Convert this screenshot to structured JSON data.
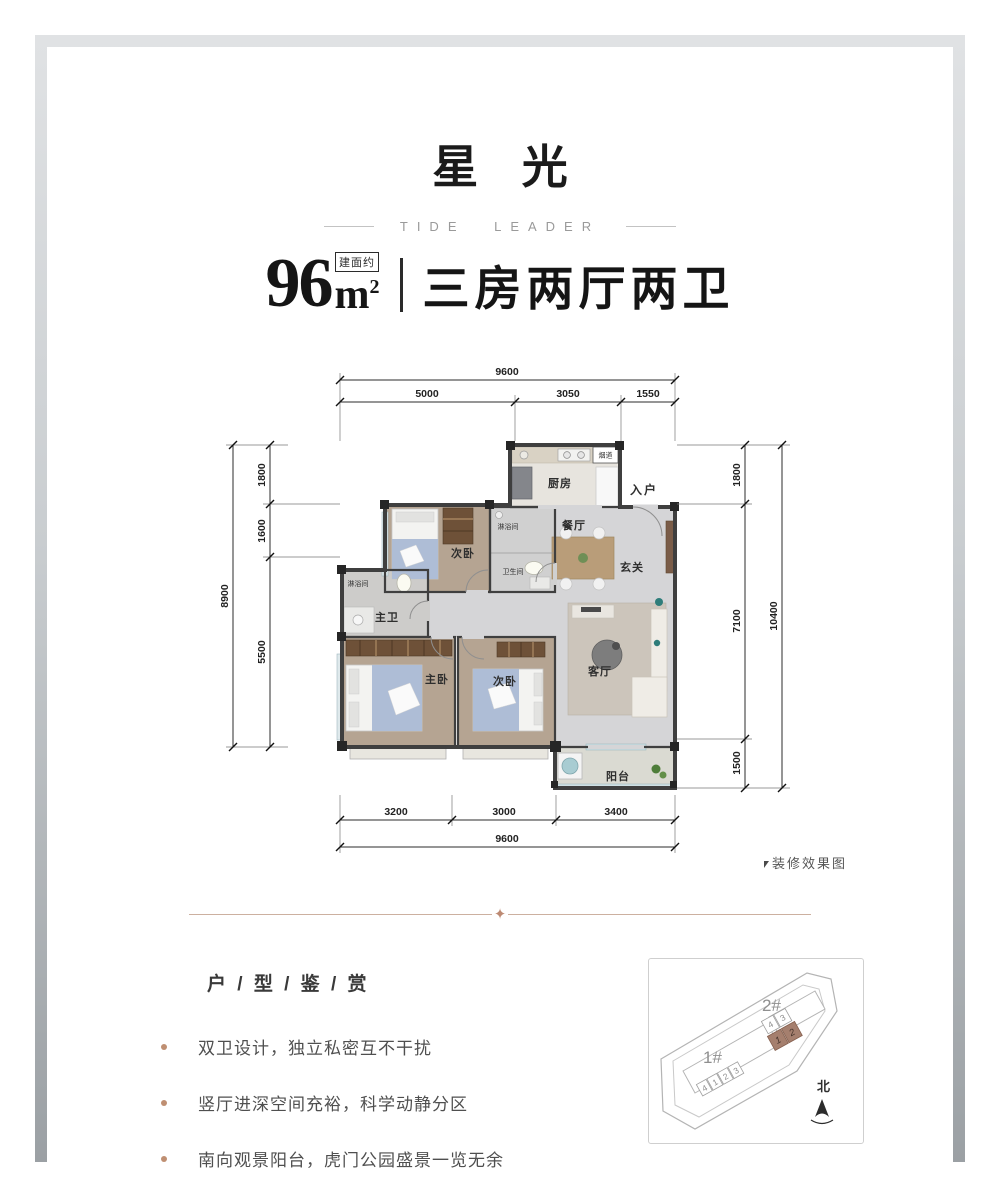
{
  "header": {
    "title": "星 光",
    "subtitle": "TIDE LEADER",
    "area": {
      "value": "96",
      "unit": "m",
      "sup": "2",
      "badge": "建面约"
    },
    "layout_text": "三房两厅两卫"
  },
  "floor_plan": {
    "note": "装修效果图",
    "labels": {
      "kitchen": "厨房",
      "flue": "烟道",
      "entry": "入户",
      "dining": "餐厅",
      "foyer": "玄关",
      "bedroom_top": "次卧",
      "shower_top": "淋浴间",
      "bathroom": "卫生间",
      "shower_left": "淋浴间",
      "master_bath": "主卫",
      "master_bedroom": "主卧",
      "bedroom_bottom": "次卧",
      "living": "客厅",
      "balcony": "阳台"
    },
    "dimensions": {
      "top": {
        "overall": "9600",
        "segments": [
          "5000",
          "3050",
          "1550"
        ]
      },
      "left": {
        "overall": "8900",
        "segments": [
          "1800",
          "1600",
          "5500"
        ]
      },
      "right": {
        "overall": "10400",
        "segments": [
          "1800",
          "7100",
          "1500"
        ]
      },
      "bottom": {
        "overall": "9600",
        "segments": [
          "3200",
          "3000",
          "3400"
        ]
      }
    }
  },
  "features": {
    "title": "户 / 型 / 鉴 / 赏",
    "bullets": [
      "双卫设计，独立私密互不干扰",
      "竖厅进深空间充裕，科学动静分区",
      "南向观景阳台，虎门公园盛景一览无余"
    ]
  },
  "sitemap": {
    "building1": "1#",
    "building2": "2#",
    "north": "北",
    "b1_units": [
      "4",
      "1",
      "2",
      "3"
    ],
    "b2_units_white": [
      "4",
      "3"
    ],
    "b2_units_highlight": [
      "1",
      "2"
    ],
    "highlight_color": "#a57f6e"
  },
  "colors": {
    "accent_copper": "#ccb0a0",
    "bullet_dot": "#bf8f72",
    "wall": "#3f3f3f"
  }
}
